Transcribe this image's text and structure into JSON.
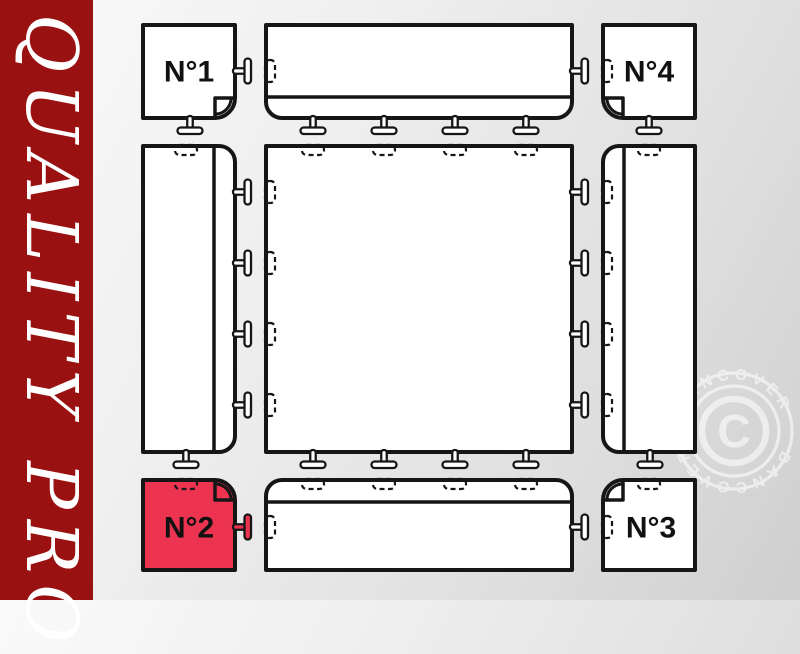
{
  "banner": {
    "text": "QUALITY PRO",
    "bg_color": "#9A1111",
    "text_color": "#FFFFFF"
  },
  "diagram": {
    "outline_color": "#161616",
    "tile_fill": "#FFFFFF",
    "highlight_color": "#EC3350",
    "tiles": [
      {
        "id": "corner-tile-1",
        "label": "N°1",
        "position": "top-left",
        "highlighted": false
      },
      {
        "id": "top-edge-tile",
        "label": "",
        "position": "top-center",
        "highlighted": false
      },
      {
        "id": "corner-tile-4",
        "label": "N°4",
        "position": "top-right",
        "highlighted": false
      },
      {
        "id": "left-edge-tile",
        "label": "",
        "position": "middle-left",
        "highlighted": false
      },
      {
        "id": "center-tile",
        "label": "",
        "position": "center",
        "highlighted": false
      },
      {
        "id": "right-edge-tile",
        "label": "",
        "position": "middle-right",
        "highlighted": false
      },
      {
        "id": "corner-tile-2",
        "label": "N°2",
        "position": "bottom-left",
        "highlighted": true
      },
      {
        "id": "bottom-edge-tile",
        "label": "",
        "position": "bottom-center",
        "highlighted": false
      },
      {
        "id": "corner-tile-3",
        "label": "N°3",
        "position": "bottom-right",
        "highlighted": false
      }
    ]
  },
  "watermark": {
    "brand": "DANCOVER",
    "symbol": "C"
  }
}
